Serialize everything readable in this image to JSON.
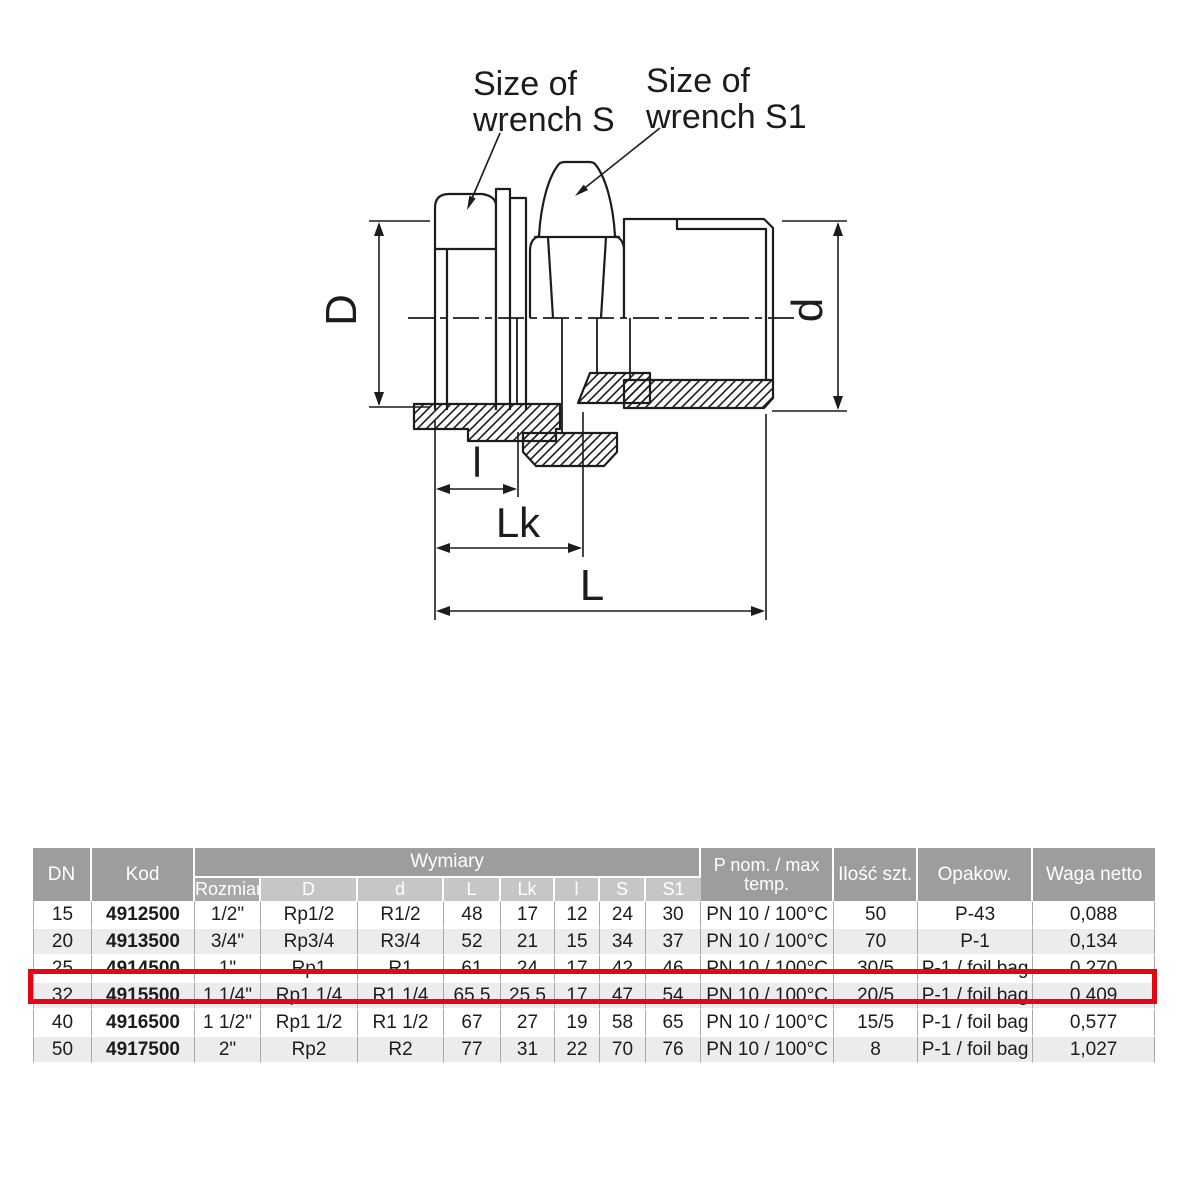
{
  "diagram": {
    "label_s": {
      "line1": "Size of",
      "line2": "wrench S"
    },
    "label_s1": {
      "line1": "Size of",
      "line2": "wrench S1"
    },
    "dims": {
      "D": "D",
      "d": "d",
      "l": "l",
      "Lk": "Lk",
      "L": "L"
    }
  },
  "table": {
    "header": {
      "dn": "DN",
      "kod": "Kod",
      "wymiary": "Wymiary",
      "sub": {
        "rozmiar": "Rozmiar",
        "D": "D",
        "d": "d",
        "L": "L",
        "Lk": "Lk",
        "l": "l",
        "S": "S",
        "S1": "S1"
      },
      "p_line1": "P nom. / max",
      "p_line2": "temp.",
      "ilosc": "Ilość szt.",
      "opakow": "Opakow.",
      "waga": "Waga netto"
    },
    "highlight_color": "#e30613",
    "rows": [
      {
        "dn": "15",
        "kod": "4912500",
        "rozmiar": "1/2\"",
        "D": "Rp1/2",
        "d": "R1/2",
        "L": "48",
        "Lk": "17",
        "l": "12",
        "S": "24",
        "S1": "30",
        "p": "PN 10 / 100°C",
        "ilosc": "50",
        "opakow": "P-43",
        "waga": "0,088"
      },
      {
        "dn": "20",
        "kod": "4913500",
        "rozmiar": "3/4\"",
        "D": "Rp3/4",
        "d": "R3/4",
        "L": "52",
        "Lk": "21",
        "l": "15",
        "S": "34",
        "S1": "37",
        "p": "PN 10 / 100°C",
        "ilosc": "70",
        "opakow": "P-1",
        "waga": "0,134"
      },
      {
        "dn": "25",
        "kod": "4914500",
        "rozmiar": "1\"",
        "D": "Rp1",
        "d": "R1",
        "L": "61",
        "Lk": "24",
        "l": "17",
        "S": "42",
        "S1": "46",
        "p": "PN 10 / 100°C",
        "ilosc": "30/5",
        "opakow": "P-1 / foil bag",
        "waga": "0.270"
      },
      {
        "dn": "32",
        "kod": "4915500",
        "rozmiar": "1 1/4\"",
        "D": "Rp1 1/4",
        "d": "R1 1/4",
        "L": "65.5",
        "Lk": "25.5",
        "l": "17",
        "S": "47",
        "S1": "54",
        "p": "PN 10 / 100°C",
        "ilosc": "20/5",
        "opakow": "P-1 / foil bag",
        "waga": "0,409"
      },
      {
        "dn": "40",
        "kod": "4916500",
        "rozmiar": "1 1/2\"",
        "D": "Rp1 1/2",
        "d": "R1 1/2",
        "L": "67",
        "Lk": "27",
        "l": "19",
        "S": "58",
        "S1": "65",
        "p": "PN 10 / 100°C",
        "ilosc": "15/5",
        "opakow": "P-1 / foil bag",
        "waga": "0,577"
      },
      {
        "dn": "50",
        "kod": "4917500",
        "rozmiar": "2\"",
        "D": "Rp2",
        "d": "R2",
        "L": "77",
        "Lk": "31",
        "l": "22",
        "S": "70",
        "S1": "76",
        "p": "PN 10 / 100°C",
        "ilosc": "8",
        "opakow": "P-1 / foil bag",
        "waga": "1,027"
      }
    ]
  }
}
